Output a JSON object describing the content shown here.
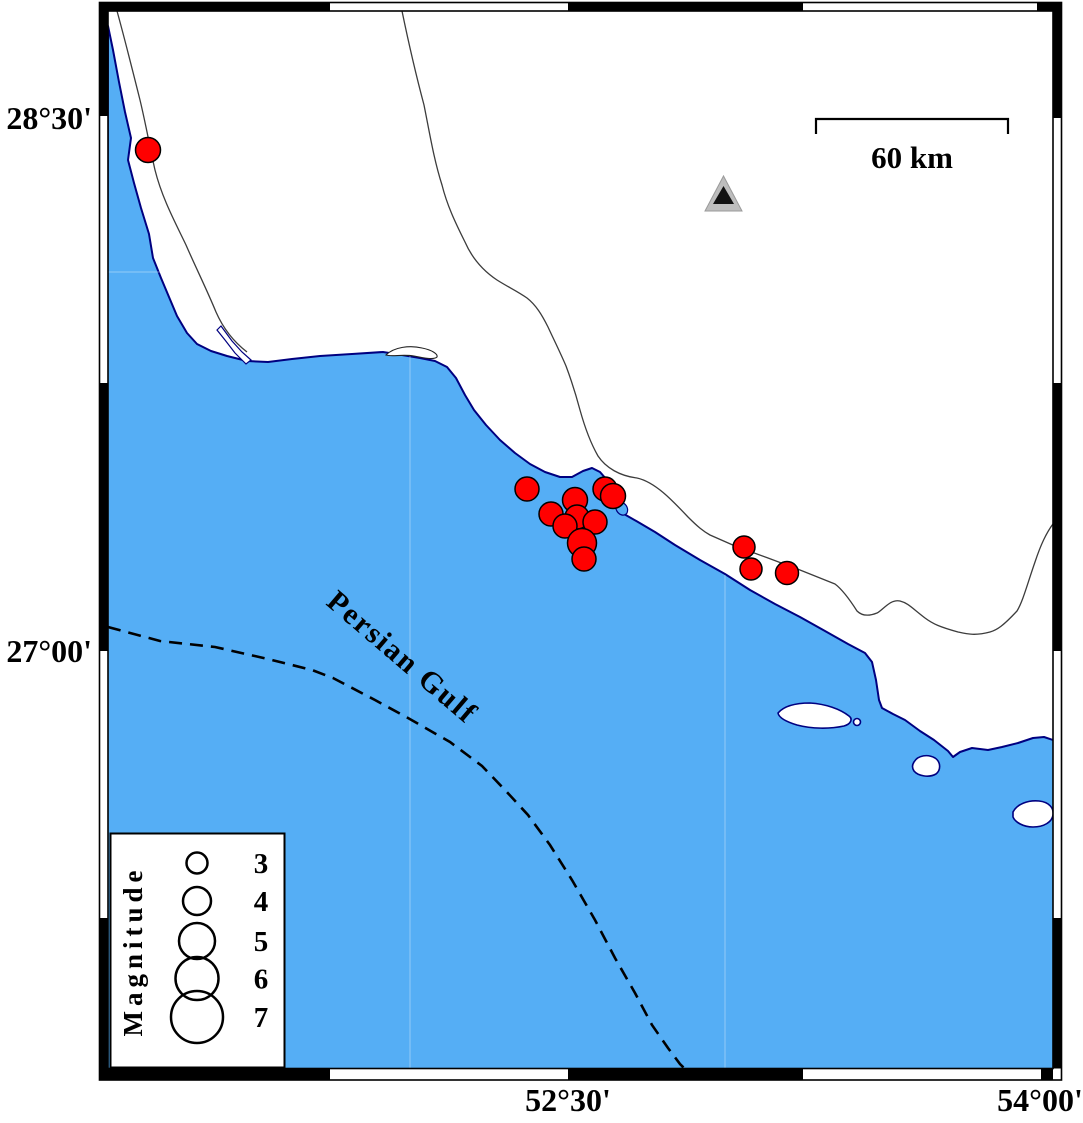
{
  "axes": {
    "lat": [
      {
        "label": "28°30'"
      },
      {
        "label": "27°00'"
      }
    ],
    "lon": [
      {
        "label": "52°30'"
      },
      {
        "label": "54°00'"
      }
    ]
  },
  "sea_label": "Persian Gulf",
  "scale_bar": {
    "label": "60 km"
  },
  "legend": {
    "title": "Magnitude",
    "items": [
      {
        "magnitude": "3",
        "radius": 10.5
      },
      {
        "magnitude": "4",
        "radius": 14
      },
      {
        "magnitude": "5",
        "radius": 18
      },
      {
        "magnitude": "6",
        "radius": 21.5
      },
      {
        "magnitude": "7",
        "radius": 26
      }
    ]
  },
  "station_marker": {
    "symbol": "triangle",
    "x": 723,
    "y": 196
  },
  "earthquakes": [
    {
      "x": 148,
      "y": 150,
      "r": 12.5
    },
    {
      "x": 527,
      "y": 489,
      "r": 12
    },
    {
      "x": 605,
      "y": 489,
      "r": 12
    },
    {
      "x": 575,
      "y": 500,
      "r": 12.5
    },
    {
      "x": 551,
      "y": 514,
      "r": 12
    },
    {
      "x": 577,
      "y": 517,
      "r": 12
    },
    {
      "x": 595,
      "y": 522,
      "r": 12
    },
    {
      "x": 613,
      "y": 496,
      "r": 12.5
    },
    {
      "x": 565,
      "y": 526,
      "r": 12
    },
    {
      "x": 582,
      "y": 543,
      "r": 14.5
    },
    {
      "x": 584,
      "y": 559,
      "r": 12
    },
    {
      "x": 744,
      "y": 547,
      "r": 11
    },
    {
      "x": 751,
      "y": 569,
      "r": 11
    },
    {
      "x": 787,
      "y": 573,
      "r": 11.5
    }
  ],
  "colors": {
    "sea": "#55AEF5",
    "coast": "#000080",
    "earthquake_fill": "#FF0000",
    "earthquake_stroke": "#000000",
    "land": "#FFFFFF",
    "frame": "#000000",
    "station_fill": "#BDBDBD",
    "station_inner": "#111111"
  }
}
